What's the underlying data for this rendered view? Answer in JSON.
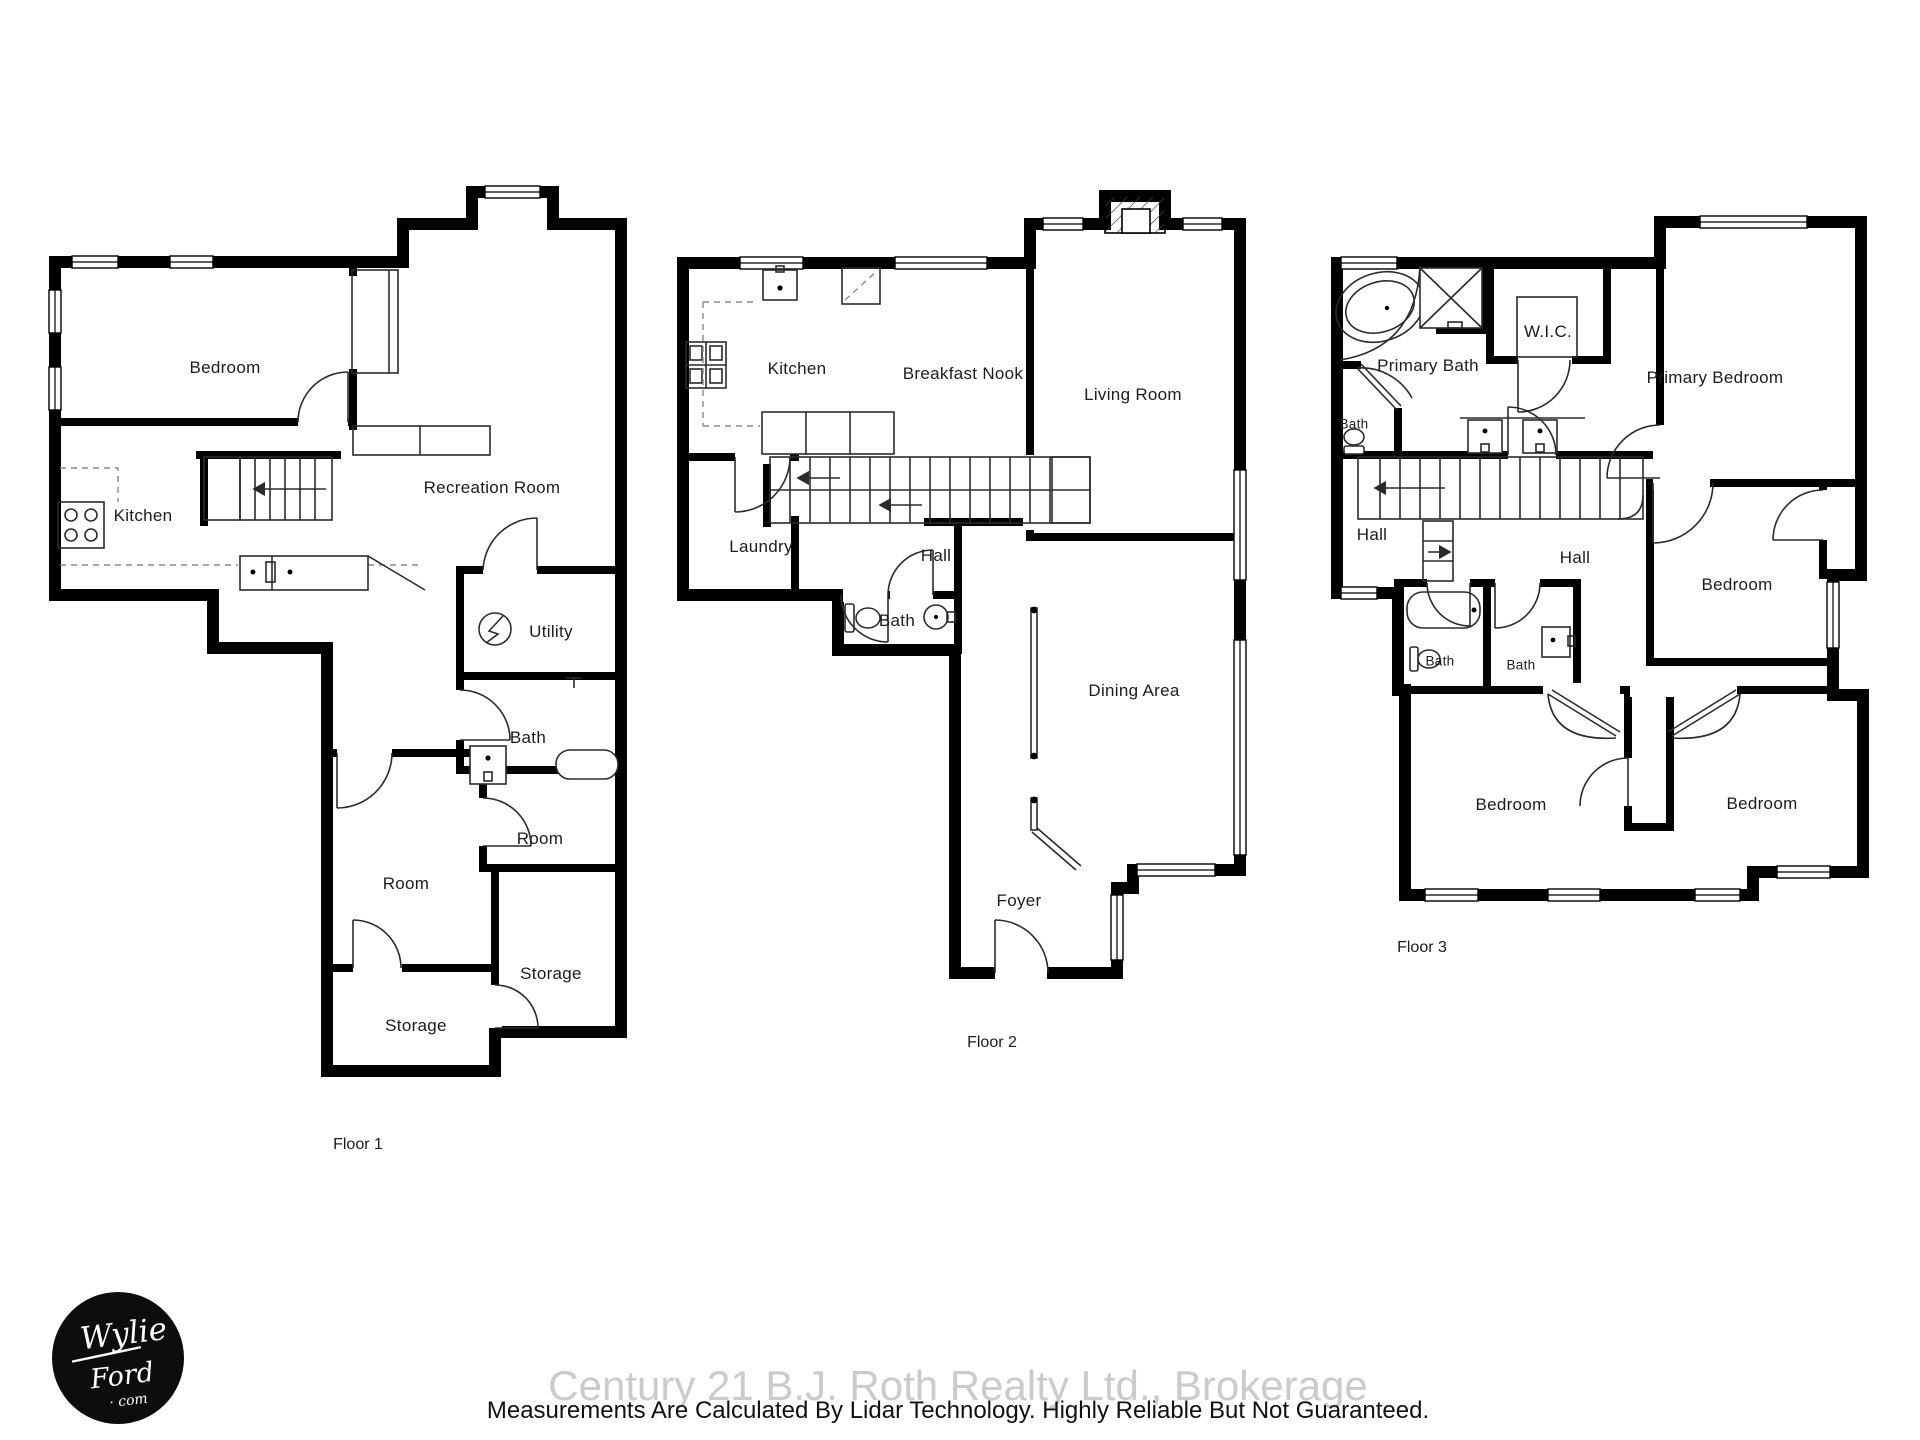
{
  "floors": [
    {
      "caption": "Floor 1",
      "rooms": {
        "bedroom": "Bedroom",
        "kitchen": "Kitchen",
        "recreation": "Recreation Room",
        "utility": "Utility",
        "bath": "Bath",
        "room_a": "Room",
        "room_b": "Room",
        "storage_a": "Storage",
        "storage_b": "Storage"
      }
    },
    {
      "caption": "Floor 2",
      "rooms": {
        "kitchen": "Kitchen",
        "breakfast_nook": "Breakfast Nook",
        "living_room": "Living Room",
        "laundry": "Laundry",
        "hall": "Hall",
        "bath": "Bath",
        "dining_area": "Dining Area",
        "foyer": "Foyer"
      }
    },
    {
      "caption": "Floor 3",
      "rooms": {
        "primary_bath": "Primary Bath",
        "wic": "W.I.C.",
        "bath_hall": "Bath",
        "primary_bedroom": "Primary Bedroom",
        "hall_a": "Hall",
        "hall_b": "Hall",
        "bath_a": "Bath",
        "bath_b": "Bath",
        "bedroom_a": "Bedroom",
        "bedroom_b": "Bedroom",
        "bedroom_c": "Bedroom"
      }
    }
  ],
  "footer": {
    "brokerage": "Century 21 B.J. Roth Realty Ltd., Brokerage",
    "disclaimer": "Measurements Are Calculated By Lidar Technology. Highly Reliable But Not Guaranteed."
  },
  "logo": {
    "word1": "Wylie",
    "word2": "Ford",
    "word3": "· com"
  }
}
